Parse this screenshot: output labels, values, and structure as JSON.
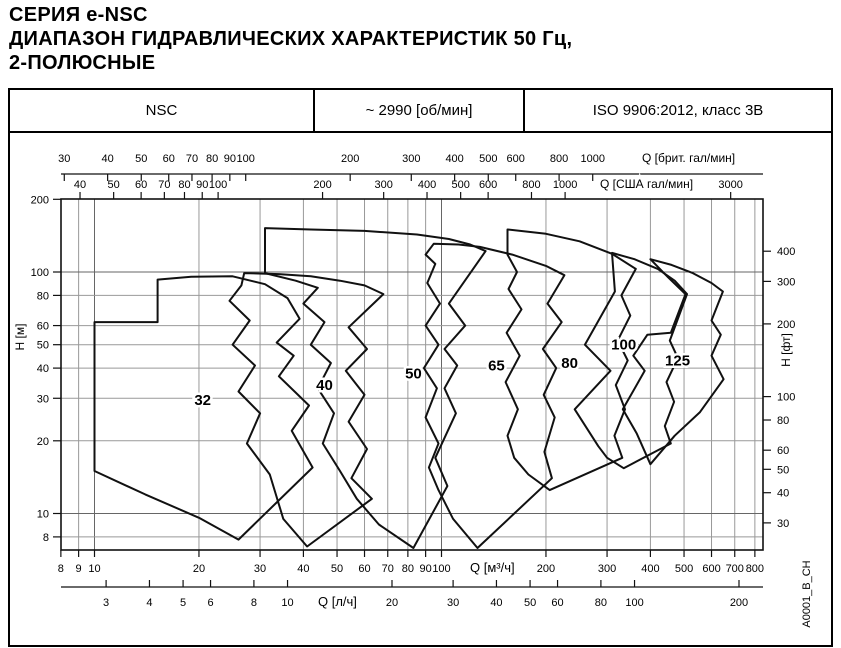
{
  "title": {
    "line1": "СЕРИЯ e-NSC",
    "line2": "ДИАПАЗОН ГИДРАВЛИЧЕСКИХ ХАРАКТЕРИСТИК 50 Гц,",
    "line3": "2-ПОЛЮСНЫЕ"
  },
  "header": {
    "series": "NSC",
    "speed": "~ 2990 [об/мин]",
    "standard": "ISO 9906:2012, класс 3В"
  },
  "watermark": "A0001_B_CH",
  "colors": {
    "line": "#111111",
    "grid_minor": "#999999",
    "grid_major": "#666666",
    "text": "#000000",
    "background": "#ffffff"
  },
  "chart_data": {
    "type": "envelope-map",
    "title": "Диапазон гидравлических характеристик e-NSC, 50 Гц, 2 полюса, ~2990 об/мин",
    "x_scale": {
      "unit": "м³/ч",
      "log": true,
      "min": 8,
      "max": 800
    },
    "y_scale": {
      "unit": "м",
      "log": true,
      "min": 8,
      "max": 200
    },
    "grid": true,
    "axes": {
      "top": [
        {
          "id": "imp-gpm",
          "label": "Q [брит. гал/мин]",
          "to_m3h": 0.27276,
          "ticks": [
            30,
            40,
            50,
            60,
            70,
            80,
            90,
            100,
            200,
            300,
            400,
            500,
            600,
            800,
            1000
          ]
        },
        {
          "id": "us-gpm",
          "label": "Q [США гал/мин]",
          "to_m3h": 0.2271,
          "ticks": [
            40,
            50,
            60,
            70,
            80,
            90,
            100,
            200,
            300,
            400,
            500,
            600,
            800,
            1000,
            3000
          ]
        }
      ],
      "bottom": [
        {
          "id": "m3h",
          "label": "Q [м³/ч]",
          "to_m3h": 1,
          "ticks": [
            8,
            9,
            10,
            20,
            30,
            40,
            50,
            60,
            70,
            80,
            90,
            100,
            200,
            300,
            400,
            500,
            600,
            700,
            800
          ]
        },
        {
          "id": "ls",
          "label": "Q [л/ч]",
          "to_m3h": 3.6,
          "ticks": [
            3,
            4,
            5,
            6,
            8,
            10,
            20,
            30,
            40,
            50,
            60,
            80,
            100,
            200
          ]
        }
      ],
      "left": {
        "id": "h-m",
        "label": "H [м]",
        "to_m": 1,
        "ticks": [
          200,
          100,
          80,
          60,
          50,
          40,
          30,
          20,
          10,
          8
        ]
      },
      "right": {
        "id": "h-ft",
        "label": "H [фт]",
        "to_m": 0.3048,
        "ticks": [
          400,
          300,
          200,
          100,
          80,
          60,
          50,
          40,
          30
        ]
      }
    },
    "regions": [
      {
        "label": "32",
        "label_at": [
          20.5,
          29.5
        ],
        "points": [
          [
            10,
            15
          ],
          [
            10,
            62
          ],
          [
            15.2,
            62
          ],
          [
            15.2,
            93
          ],
          [
            19,
            95.5
          ],
          [
            25,
            96
          ],
          [
            31,
            89
          ],
          [
            36,
            78
          ],
          [
            39,
            64
          ],
          [
            33.5,
            51
          ],
          [
            37.5,
            45
          ],
          [
            34,
            37
          ],
          [
            41.5,
            28
          ],
          [
            37,
            22
          ],
          [
            42.5,
            15.5
          ],
          [
            26,
            7.8
          ],
          [
            20,
            9.6
          ],
          [
            14,
            12
          ]
        ]
      },
      {
        "label": "40",
        "label_at": [
          46,
          34
        ],
        "points": [
          [
            27,
            99
          ],
          [
            34,
            98
          ],
          [
            42,
            96
          ],
          [
            51,
            92
          ],
          [
            60,
            88
          ],
          [
            68,
            81
          ],
          [
            54,
            59
          ],
          [
            61,
            48
          ],
          [
            53,
            39
          ],
          [
            60,
            31
          ],
          [
            54,
            24
          ],
          [
            61,
            18.5
          ],
          [
            55,
            14
          ],
          [
            63,
            11.5
          ],
          [
            41,
            7.3
          ],
          [
            35,
            9.5
          ],
          [
            32,
            14.5
          ],
          [
            27.5,
            19.5
          ],
          [
            30,
            26
          ],
          [
            26,
            32
          ],
          [
            29,
            41
          ],
          [
            25,
            50
          ],
          [
            28,
            63
          ],
          [
            24.5,
            76
          ],
          [
            26.5,
            88
          ]
        ]
      },
      {
        "label": "50",
        "label_at": [
          83,
          38
        ],
        "points": [
          [
            31,
            99
          ],
          [
            31,
            152
          ],
          [
            42,
            150
          ],
          [
            60,
            148
          ],
          [
            85,
            143
          ],
          [
            105,
            137
          ],
          [
            121,
            130
          ],
          [
            134,
            122
          ],
          [
            105,
            74
          ],
          [
            117,
            60
          ],
          [
            102,
            48
          ],
          [
            111,
            41
          ],
          [
            102,
            33
          ],
          [
            110,
            26
          ],
          [
            96,
            17
          ],
          [
            104,
            13
          ],
          [
            83,
            7.2
          ],
          [
            66,
            9
          ],
          [
            57,
            11.5
          ],
          [
            51,
            15
          ],
          [
            45.5,
            19.5
          ],
          [
            49,
            26
          ],
          [
            44,
            33
          ],
          [
            48,
            42
          ],
          [
            42,
            50
          ],
          [
            46,
            62
          ],
          [
            40,
            74
          ],
          [
            44,
            86
          ],
          [
            38,
            92
          ]
        ]
      },
      {
        "label": "65",
        "label_at": [
          144,
          41
        ],
        "points": [
          [
            95,
            131
          ],
          [
            112,
            130
          ],
          [
            129,
            127
          ],
          [
            160,
            118
          ],
          [
            200,
            106
          ],
          [
            226,
            97
          ],
          [
            202,
            74
          ],
          [
            222,
            62
          ],
          [
            196,
            48
          ],
          [
            214,
            40
          ],
          [
            197,
            31
          ],
          [
            212,
            25
          ],
          [
            198,
            18
          ],
          [
            208,
            14
          ],
          [
            127,
            7.2
          ],
          [
            108,
            9.5
          ],
          [
            98,
            12.5
          ],
          [
            92,
            15.5
          ],
          [
            98,
            19.5
          ],
          [
            90,
            25
          ],
          [
            97,
            33
          ],
          [
            89,
            40
          ],
          [
            98,
            50
          ],
          [
            90,
            60
          ],
          [
            99,
            74
          ],
          [
            91,
            90
          ],
          [
            96,
            108
          ],
          [
            90,
            118
          ]
        ]
      },
      {
        "label": "80",
        "label_at": [
          234,
          42
        ],
        "points": [
          [
            155,
            118
          ],
          [
            155,
            150
          ],
          [
            200,
            144
          ],
          [
            250,
            134
          ],
          [
            310,
            119
          ],
          [
            363,
            103
          ],
          [
            330,
            80
          ],
          [
            350,
            66
          ],
          [
            322,
            52
          ],
          [
            344,
            43
          ],
          [
            318,
            34
          ],
          [
            338,
            27
          ],
          [
            315,
            21
          ],
          [
            332,
            17
          ],
          [
            205,
            12.5
          ],
          [
            178,
            14.5
          ],
          [
            162,
            17
          ],
          [
            155,
            21
          ],
          [
            166,
            27
          ],
          [
            153,
            35
          ],
          [
            168,
            45
          ],
          [
            154,
            56
          ],
          [
            170,
            70
          ],
          [
            156,
            85
          ],
          [
            165,
            100
          ]
        ]
      },
      {
        "label": "100",
        "label_at": [
          335,
          50
        ],
        "points": [
          [
            310,
            120
          ],
          [
            360,
            113
          ],
          [
            420,
            103
          ],
          [
            470,
            92
          ],
          [
            510,
            81
          ],
          [
            455,
            52
          ],
          [
            480,
            44
          ],
          [
            445,
            35
          ],
          [
            468,
            29
          ],
          [
            440,
            23
          ],
          [
            458,
            19.5
          ],
          [
            335,
            15.4
          ],
          [
            300,
            17
          ],
          [
            283,
            19
          ],
          [
            242,
            27
          ],
          [
            307,
            39
          ],
          [
            259,
            50
          ],
          [
            316,
            83
          ]
        ]
      },
      {
        "label": "125",
        "label_at": [
          479,
          43
        ],
        "points": [
          [
            400,
            113
          ],
          [
            460,
            107
          ],
          [
            530,
            99
          ],
          [
            600,
            90
          ],
          [
            647,
            83
          ],
          [
            600,
            63
          ],
          [
            638,
            55
          ],
          [
            600,
            45
          ],
          [
            650,
            36
          ],
          [
            556,
            26.3
          ],
          [
            470,
            21
          ],
          [
            400,
            16
          ],
          [
            365,
            21.5
          ],
          [
            333,
            27
          ],
          [
            385,
            39
          ],
          [
            357,
            45
          ],
          [
            392,
            55
          ],
          [
            458,
            56
          ],
          [
            505,
            81
          ],
          [
            450,
            95
          ]
        ]
      }
    ]
  }
}
